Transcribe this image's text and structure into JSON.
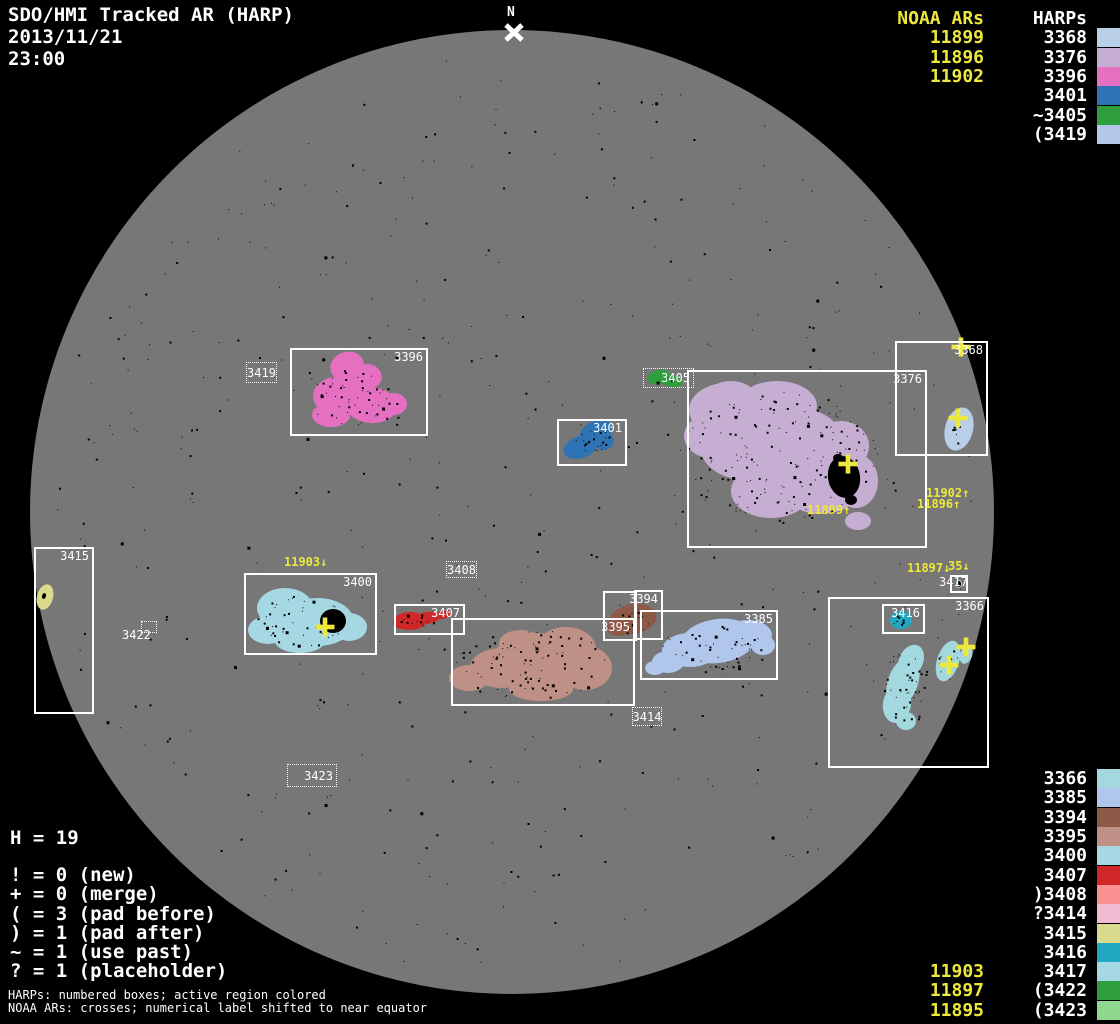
{
  "title": {
    "line1": "SDO/HMI Tracked AR (HARP)",
    "date": "2013/11/21",
    "time": "23:00"
  },
  "north_marker": {
    "label": "N"
  },
  "colors": {
    "yellow": "#ece83c",
    "disk": "#777777",
    "background": "#000000",
    "box_white": "#ffffff"
  },
  "legend_top_right": {
    "noaa_header": "NOAA ARs",
    "harp_header": "HARPs",
    "rows": [
      {
        "noaa": "11899",
        "harp": "3368",
        "color": "#b9cfe8"
      },
      {
        "noaa": "11896",
        "harp": "3376",
        "color": "#c6aed3"
      },
      {
        "noaa": "11902",
        "harp": "3396",
        "color": "#e570c2"
      },
      {
        "noaa": "",
        "harp": "3401",
        "color": "#2e74b5"
      },
      {
        "noaa": "",
        "harp": "~3405",
        "color": "#2f9e3f"
      },
      {
        "noaa": "",
        "harp": "(3419",
        "color": "#b4c7e7"
      }
    ]
  },
  "legend_bottom_right": {
    "rows": [
      {
        "noaa": "",
        "harp": "3366",
        "color": "#a3d8de"
      },
      {
        "noaa": "",
        "harp": "3385",
        "color": "#b0c6ea"
      },
      {
        "noaa": "",
        "harp": "3394",
        "color": "#8f5948"
      },
      {
        "noaa": "",
        "harp": "3395",
        "color": "#bf9086"
      },
      {
        "noaa": "",
        "harp": "3400",
        "color": "#a6d8e4"
      },
      {
        "noaa": "",
        "harp": "3407",
        "color": "#d02828"
      },
      {
        "noaa": "",
        "harp": ")3408",
        "color": "#fb9090"
      },
      {
        "noaa": "",
        "harp": "?3414",
        "color": "#f2bcd3"
      },
      {
        "noaa": "",
        "harp": "3415",
        "color": "#dada8e"
      },
      {
        "noaa": "",
        "harp": "3416",
        "color": "#23a8c4"
      },
      {
        "noaa": "11903",
        "harp": "3417",
        "color": "#a6d8e4"
      },
      {
        "noaa": "11897",
        "harp": "(3422",
        "color": "#2f9e3f"
      },
      {
        "noaa": "11895",
        "harp": "(3423",
        "color": "#90d890"
      }
    ]
  },
  "stats": {
    "h": "H = 19",
    "lines": [
      "! = 0 (new)",
      "+ = 0 (merge)",
      "( = 3 (pad before)",
      ") = 1 (pad after)",
      "~ = 1 (use past)",
      "? = 1 (placeholder)"
    ]
  },
  "footer": {
    "line1": "HARPs: numbered boxes; active region colored",
    "line2": "NOAA ARs: crosses; numerical label shifted to near equator"
  },
  "harp_boxes": [
    {
      "harp": "3396",
      "label": "3396",
      "style": "solid",
      "label_pos": "tr",
      "x": 290,
      "y": 348,
      "w": 138,
      "h": 88
    },
    {
      "harp": "3376",
      "label": "3376",
      "style": "solid",
      "label_pos": "tr",
      "x": 687,
      "y": 370,
      "w": 240,
      "h": 178
    },
    {
      "harp": "3401",
      "label": "3401",
      "style": "solid",
      "label_pos": "tr",
      "x": 557,
      "y": 419,
      "w": 70,
      "h": 47
    },
    {
      "harp": "3368",
      "label": "3368",
      "style": "solid",
      "label_pos": "tr",
      "x": 895,
      "y": 341,
      "w": 93,
      "h": 115
    },
    {
      "harp": "3415",
      "label": "3415",
      "style": "solid",
      "label_pos": "tr",
      "x": 34,
      "y": 547,
      "w": 60,
      "h": 167
    },
    {
      "harp": "3400",
      "label": "3400",
      "style": "solid",
      "label_pos": "tr",
      "x": 244,
      "y": 573,
      "w": 133,
      "h": 82
    },
    {
      "harp": "3407",
      "label": "3407",
      "style": "solid",
      "label_pos": "tr",
      "x": 394,
      "y": 604,
      "w": 71,
      "h": 31
    },
    {
      "harp": "3394",
      "label": "3394",
      "style": "solid",
      "label_pos": "tr",
      "x": 634,
      "y": 590,
      "w": 29,
      "h": 50
    },
    {
      "harp": "3395-outline",
      "label": "",
      "style": "solid",
      "label_pos": "none",
      "x": 603,
      "y": 591,
      "w": 34,
      "h": 50
    },
    {
      "harp": "3395",
      "label": "3395",
      "style": "solid",
      "label_pos": "tr",
      "x": 451,
      "y": 618,
      "w": 184,
      "h": 88
    },
    {
      "harp": "3385",
      "label": "3385",
      "style": "solid",
      "label_pos": "tr",
      "x": 640,
      "y": 610,
      "w": 138,
      "h": 70
    },
    {
      "harp": "3366",
      "label": "3366",
      "style": "solid",
      "label_pos": "tr",
      "x": 828,
      "y": 597,
      "w": 161,
      "h": 171
    },
    {
      "harp": "3416",
      "label": "3416",
      "style": "solid",
      "label_pos": "tr",
      "x": 882,
      "y": 604,
      "w": 43,
      "h": 30
    },
    {
      "harp": "3417",
      "label": "",
      "style": "solid",
      "label_pos": "none",
      "x": 950,
      "y": 575,
      "w": 18,
      "h": 18
    },
    {
      "harp": "3419",
      "label": "3419",
      "style": "dotted",
      "label_pos": "center",
      "x": 246,
      "y": 362,
      "w": 31,
      "h": 21
    },
    {
      "harp": "3405",
      "label": "3405",
      "style": "dotted",
      "label_pos": "right",
      "x": 643,
      "y": 368,
      "w": 51,
      "h": 20
    },
    {
      "harp": "3408",
      "label": "3408",
      "style": "dotted",
      "label_pos": "center",
      "x": 446,
      "y": 561,
      "w": 31,
      "h": 17
    },
    {
      "harp": "3414",
      "label": "3414",
      "style": "dotted",
      "label_pos": "center",
      "x": 632,
      "y": 707,
      "w": 30,
      "h": 19
    },
    {
      "harp": "3422",
      "label": "",
      "style": "dotted",
      "label_pos": "none",
      "x": 141,
      "y": 621,
      "w": 16,
      "h": 12
    },
    {
      "harp": "3423",
      "label": "3423",
      "style": "dotted",
      "label_pos": "right",
      "x": 287,
      "y": 764,
      "w": 50,
      "h": 23
    }
  ],
  "plain_labels": [
    {
      "text": "3417",
      "x": 939,
      "y": 576
    },
    {
      "text": "3422",
      "x": 122,
      "y": 629
    }
  ],
  "noaa_labels": [
    {
      "text": "11903↓",
      "x": 284,
      "y": 556
    },
    {
      "text": "11899↑",
      "x": 807,
      "y": 504
    },
    {
      "text": "11902↑",
      "x": 926,
      "y": 487
    },
    {
      "text": "11896↑",
      "x": 917,
      "y": 498
    },
    {
      "text": "11897↓",
      "x": 907,
      "y": 562
    },
    {
      "text": "35↓",
      "x": 948,
      "y": 560
    }
  ],
  "crosses": [
    {
      "x": 961,
      "y": 347
    },
    {
      "x": 958,
      "y": 418
    },
    {
      "x": 848,
      "y": 464
    },
    {
      "x": 325,
      "y": 627
    },
    {
      "x": 949,
      "y": 665
    },
    {
      "x": 966,
      "y": 647
    }
  ],
  "chart_data": {
    "type": "scatter",
    "title": "SDO/HMI Tracked AR (HARP)",
    "datetime": "2013/11/21 23:00",
    "harp_count": 19,
    "noaa_ars_listed_top": [
      "11899",
      "11896",
      "11902"
    ],
    "harps_listed_top": [
      "3368",
      "3376",
      "3396",
      "3401",
      "~3405",
      "(3419"
    ],
    "harps_listed_bottom": [
      "3366",
      "3385",
      "3394",
      "3395",
      "3400",
      "3407",
      ")3408",
      "?3414",
      "3415",
      "3416",
      "3417",
      "(3422",
      "(3423"
    ],
    "noaa_ars_listed_bottom": [
      "11903",
      "11897",
      "11895"
    ],
    "flags": {
      "new": 0,
      "merge": 0,
      "pad_before": 3,
      "pad_after": 1,
      "use_past": 1,
      "placeholder": 1
    }
  }
}
